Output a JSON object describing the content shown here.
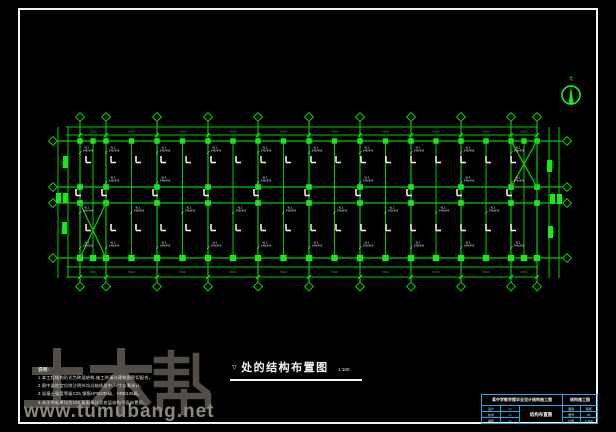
{
  "colors": {
    "bg": "#000000",
    "line_green": "#00cc00",
    "fill_green": "#19e819",
    "text_green": "#00d400",
    "white": "#f2f2f2",
    "pale_yellow": "#efe9b8",
    "cyan": "#2aa7e0",
    "wm_dark": "#57534b",
    "wm_light": "#8d897f",
    "frame_white": "#f4f4f4"
  },
  "watermark": {
    "brand": "土木帮",
    "url": "www.tumubang.net"
  },
  "north_arrow": {
    "label": "北"
  },
  "title": {
    "prefix": "▽",
    "text": "处的结构布置图",
    "scale": "1:100"
  },
  "notes": {
    "heading": "说明:",
    "lines": [
      "1.本工程结构形式为砖混结构,施工时请与建筑图密切配合。",
      "2.图中梁柱定位除注明外均沿轴线居中,尺寸以毫米计。",
      "3.混凝土强度等级C25,钢筋HPB235级、HRB335级。",
      "4.未注明板厚均为100,板配筋详见各层结构平面布置图。"
    ]
  },
  "title_block": {
    "header_left": "某中学教学楼毕业设计结构施工图",
    "header_right": "结构施工图",
    "left_rows": [
      [
        "设计",
        "××"
      ],
      [
        "校对",
        "××"
      ],
      [
        "审核",
        "××"
      ]
    ],
    "center_title": "结构布置图",
    "right_rows": [
      [
        "图别",
        "结施"
      ],
      [
        "图号",
        "05"
      ],
      [
        "比例",
        "1:100"
      ]
    ]
  },
  "plan": {
    "primary_x": [
      80,
      106,
      157,
      208,
      258,
      309,
      360,
      411,
      461,
      511,
      537
    ],
    "secondary_x": [
      93,
      131.5,
      182.5,
      233,
      283.5,
      334.5,
      385.5,
      436,
      486,
      524
    ],
    "rows_y": [
      141,
      187,
      203,
      258
    ],
    "top_dim": {
      "y1": 127,
      "y2": 135,
      "text_y": 131.5,
      "x1": 66,
      "x2": 538,
      "labels": [
        "1800",
        "3600",
        "3600",
        "3600",
        "3600",
        "3600",
        "3600",
        "3600",
        "3600",
        "1800"
      ]
    },
    "bottom_dim": {
      "y1": 267,
      "y2": 277,
      "text_y": 272,
      "x1": 66,
      "x2": 538,
      "labels": [
        "1800",
        "3600",
        "3600",
        "3600",
        "3600",
        "3600",
        "3600",
        "3600",
        "3600",
        "1800"
      ]
    },
    "left_dim": {
      "xa": 58,
      "xb": 68,
      "text_x": 63,
      "y1": 127,
      "y2": 278,
      "labels": [
        "3300",
        "1200",
        "3900"
      ]
    },
    "right_dim": {
      "xa": 549,
      "xb": 559,
      "text_x": 554,
      "y1": 127,
      "y2": 278,
      "labels": [
        "3300",
        "1200",
        "3900"
      ]
    },
    "bubbles": {
      "top_y": 117,
      "bottom_y": 286.5,
      "left_x": 53,
      "right_x": 567,
      "r": 4.4
    },
    "braces": [
      {
        "x1": 80,
        "y1": 203,
        "x2": 106,
        "y2": 258
      },
      {
        "x1": 511,
        "y1": 141,
        "x2": 537,
        "y2": 187
      }
    ],
    "beam_symbol_rows": [
      {
        "y": 156,
        "step_xs": [
          86,
          111,
          136,
          161,
          186,
          211,
          236,
          261,
          286,
          311,
          336,
          361,
          386,
          411,
          436,
          461,
          486,
          511
        ]
      },
      {
        "y": 224,
        "step_xs": [
          86,
          111,
          136,
          161,
          186,
          211,
          236,
          261,
          286,
          311,
          336,
          361,
          386,
          411,
          436,
          461,
          486,
          511
        ]
      },
      {
        "y": 189,
        "step_xs": [
          76,
          102,
          153,
          204,
          254,
          305,
          356,
          407,
          457,
          507
        ]
      }
    ],
    "label_text": {
      "l1": "KL1",
      "l2": "240x450"
    },
    "label_rows": [
      {
        "y": 146,
        "xs": [
          83,
          109,
          160,
          211,
          261,
          312,
          363,
          414,
          464,
          514
        ]
      },
      {
        "y": 176,
        "xs": [
          109,
          160,
          261,
          363,
          464,
          514
        ]
      },
      {
        "y": 206,
        "xs": [
          83,
          134,
          185,
          236,
          286,
          337,
          388,
          439,
          489
        ]
      },
      {
        "y": 241,
        "xs": [
          83,
          109,
          160,
          211,
          261,
          312,
          363,
          414,
          464,
          514
        ]
      }
    ],
    "side_marks": [
      [
        63,
        156,
        5,
        12
      ],
      [
        56,
        193,
        5,
        10
      ],
      [
        63,
        193,
        5,
        10
      ],
      [
        62,
        222,
        5,
        12
      ],
      [
        547,
        160,
        5,
        12
      ],
      [
        550,
        194,
        5,
        10
      ],
      [
        557,
        194,
        5,
        10
      ],
      [
        548,
        226,
        5,
        12
      ]
    ],
    "north": {
      "cx": 571,
      "cy": 95,
      "r": 9,
      "label_y": 80
    }
  }
}
